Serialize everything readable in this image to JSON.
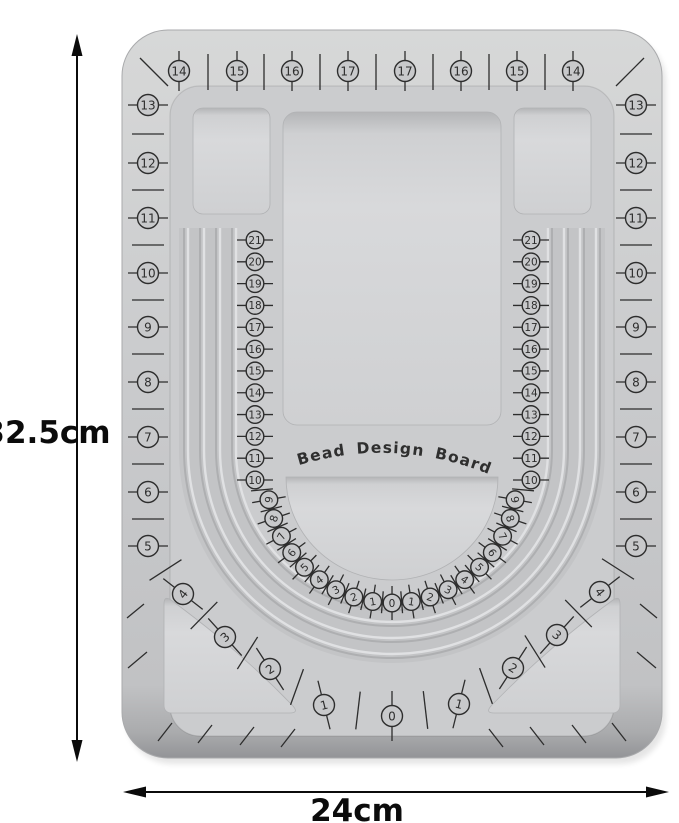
{
  "board_title": "Bead Design Board",
  "measurements": {
    "height_label": "32.5cm",
    "width_label": "24cm"
  },
  "outer_scale": {
    "top": [
      "14",
      "15",
      "16",
      "17",
      "17",
      "16",
      "15",
      "14"
    ],
    "left_column": [
      "13",
      "12",
      "11",
      "10",
      "9",
      "8",
      "7",
      "6",
      "5"
    ],
    "right_column": [
      "13",
      "12",
      "11",
      "10",
      "9",
      "8",
      "7",
      "6",
      "5"
    ],
    "bottom_arc": [
      "4",
      "3",
      "2",
      "1",
      "0",
      "1",
      "2",
      "3",
      "4"
    ]
  },
  "inner_scale": {
    "left_column": [
      "21",
      "20",
      "19",
      "18",
      "17",
      "16",
      "15",
      "14",
      "13",
      "12",
      "11",
      "10"
    ],
    "right_column": [
      "21",
      "20",
      "19",
      "18",
      "17",
      "16",
      "15",
      "14",
      "13",
      "12",
      "11",
      "10"
    ],
    "bottom_arc": [
      "9",
      "8",
      "7",
      "6",
      "5",
      "4",
      "3",
      "2",
      "1",
      "0",
      "1",
      "2",
      "3",
      "4",
      "5",
      "6",
      "7",
      "8",
      "9"
    ]
  },
  "colors": {
    "background": "#ffffff",
    "board": "#c8c9cb",
    "recess": "#d5d6d8",
    "groove_dark": "#aeafb1",
    "groove_light": "#e0e1e3",
    "ink": "#2d2d2d",
    "annotation": "#0b0b0b"
  }
}
